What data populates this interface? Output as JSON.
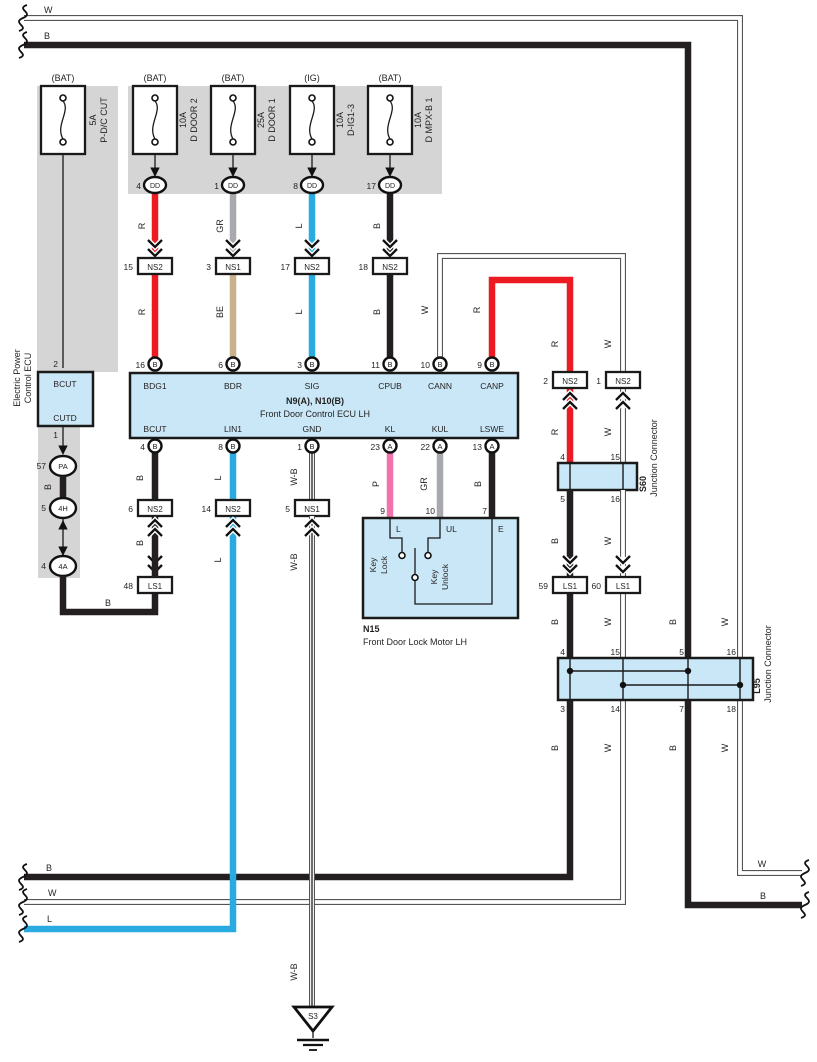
{
  "colors": {
    "red": "#EC1B23",
    "blue": "#29ABE2",
    "pink": "#F173AC",
    "gray": "#A7A9AC",
    "beige": "#C8B18B",
    "black": "#231F20",
    "white_wire": "#FFFFFF",
    "box_fill": "#C9E7F6",
    "shade": "#D5D5D5"
  },
  "top_bus": {
    "w": "W",
    "b": "B"
  },
  "bottom_bus": {
    "b": "B",
    "w": "W",
    "l": "L"
  },
  "right_bus": {
    "w": "W",
    "b": "B"
  },
  "dd": "DD",
  "fuses": [
    {
      "feed": "(BAT)",
      "rating": "5A",
      "name": "P-D/C CUT"
    },
    {
      "feed": "(BAT)",
      "rating": "10A",
      "name": "D DOOR 2",
      "dd_pin": "4",
      "upper_wire": "R",
      "ns_num": "15",
      "ns_name": "NS2",
      "lower_wire": "R"
    },
    {
      "feed": "(BAT)",
      "rating": "25A",
      "name": "D DOOR 1",
      "dd_pin": "1",
      "upper_wire": "GR",
      "ns_num": "3",
      "ns_name": "NS1",
      "lower_wire": "BE"
    },
    {
      "feed": "(IG)",
      "rating": "10A",
      "name": "D-IG1-3",
      "dd_pin": "8",
      "upper_wire": "L",
      "ns_num": "17",
      "ns_name": "NS2",
      "lower_wire": "L"
    },
    {
      "feed": "(BAT)",
      "rating": "10A",
      "name": "D MPX-B 1",
      "dd_pin": "17",
      "upper_wire": "B",
      "ns_num": "18",
      "ns_name": "NS2",
      "lower_wire": "B"
    }
  ],
  "power_ecu": {
    "label_line1": "Electric Power",
    "label_line2": "Control ECU",
    "pin_in": "2",
    "terminal_in": "BCUT",
    "terminal_out": "CUTD",
    "pin_out": "1"
  },
  "left_chain": {
    "pa_num": "57",
    "pa": "PA",
    "seg1": "B",
    "h4_num": "5",
    "h4": "4H",
    "a4_num": "4",
    "a4": "4A",
    "seg2": "B",
    "ls1_num": "48",
    "ls1": "LS1",
    "seg3": "B",
    "ns2_num": "6",
    "ns2": "NS2",
    "seg4": "B"
  },
  "ecu": {
    "code": "N9(A), N10(B)",
    "name": "Front Door Control ECU LH",
    "top_pins": [
      {
        "num": "16",
        "letter": "B",
        "terminal": "BDG1"
      },
      {
        "num": "6",
        "letter": "B",
        "terminal": "BDR"
      },
      {
        "num": "3",
        "letter": "B",
        "terminal": "SIG"
      },
      {
        "num": "11",
        "letter": "B",
        "terminal": "CPUB"
      },
      {
        "num": "10",
        "letter": "B",
        "terminal": "CANN"
      },
      {
        "num": "9",
        "letter": "B",
        "terminal": "CANP"
      }
    ],
    "bottom_pins": [
      {
        "num": "4",
        "letter": "B",
        "terminal": "BCUT"
      },
      {
        "num": "8",
        "letter": "B",
        "terminal": "LIN1"
      },
      {
        "num": "1",
        "letter": "B",
        "terminal": "GND"
      },
      {
        "num": "23",
        "letter": "A",
        "terminal": "KL"
      },
      {
        "num": "22",
        "letter": "A",
        "terminal": "KUL"
      },
      {
        "num": "13",
        "letter": "A",
        "terminal": "LSWE"
      }
    ]
  },
  "lin1_branch": {
    "seg1": "L",
    "ns2_num": "14",
    "ns2": "NS2",
    "seg2": "L"
  },
  "gnd_branch": {
    "seg1": "W-B",
    "ns1_num": "5",
    "ns1": "NS1",
    "seg2": "W-B",
    "seg3": "W-B",
    "ground": "S3"
  },
  "motor": {
    "code": "N15",
    "name": "Front Door Lock Motor LH",
    "kl_wire": "P",
    "kul_wire": "GR",
    "lswe_wire": "B",
    "pin_l_num": "9",
    "pin_l": "L",
    "pin_ul_num": "10",
    "pin_ul": "UL",
    "pin_e_num": "7",
    "pin_e": "E",
    "switch1_line1": "Key",
    "switch1_line2": "Lock",
    "switch2_line1": "Key",
    "switch2_line2": "Unlock"
  },
  "can_branch": {
    "cann_wire": "W",
    "canp_wire": "R",
    "ns2_2_num": "2",
    "ns2_2": "NS2",
    "ns2_1_num": "1",
    "ns2_1": "NS2",
    "r_seg2": "R",
    "w_seg2": "W"
  },
  "s60": {
    "code": "S60",
    "name": "Junction Connector",
    "pin_in_b": "4",
    "pin_in_w": "15",
    "pin_out_b": "5",
    "pin_out_w": "16",
    "b_seg": "B",
    "w_seg": "W",
    "ls1_b_num": "59",
    "ls1_b": "LS1",
    "ls1_w_num": "60",
    "ls1_w": "LS1",
    "b_seg2": "B",
    "w_seg2": "W"
  },
  "l95": {
    "code": "L95",
    "name": "Junction Connector",
    "top_pins": [
      "4",
      "15",
      "5",
      "16"
    ],
    "bottom_pins": [
      "3",
      "14",
      "7",
      "18"
    ],
    "below_wires": [
      "B",
      "W",
      "B",
      "W"
    ],
    "long_b": "B",
    "long_w": "W"
  }
}
